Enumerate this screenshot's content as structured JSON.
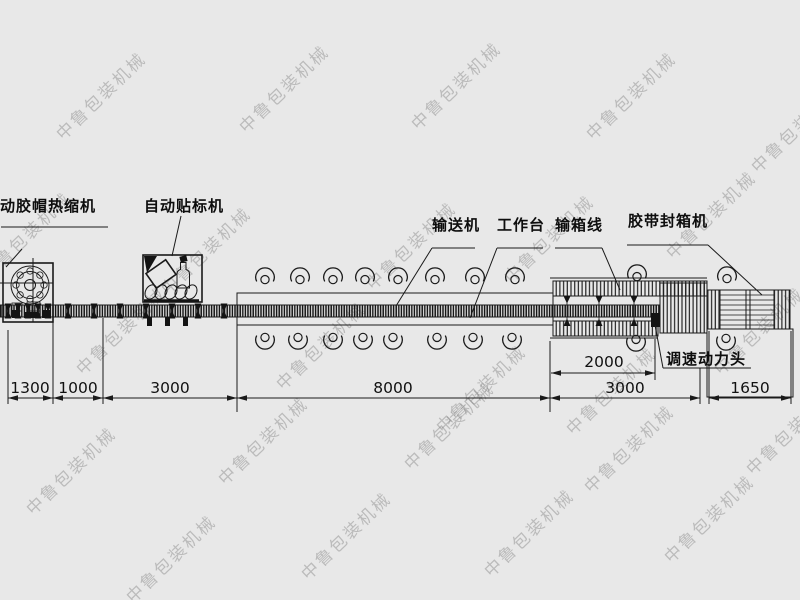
{
  "watermark": {
    "text": "中鲁包装机械"
  },
  "machine_labels": {
    "heat_shrink": "动胶帽热缩机",
    "labeler": "自动贴标机",
    "conveyor": "输送机",
    "worktable": "工作台",
    "box_line": "输箱线",
    "tape_sealer": "胶带封箱机",
    "power_head": "调速动力头"
  },
  "dimensions_mm": {
    "shrink_zone": "1300",
    "gap_zone": "1000",
    "infeed_conveyor": "3000",
    "worktable_conveyor": "8000",
    "box_line_rollers": "2000",
    "box_line_total": "3000",
    "tape_sealer": "1650"
  },
  "icons": {
    "operator_symbol": "operator-top-view-icon",
    "bottle_symbol": "bottle-top-view-icon"
  },
  "colors": {
    "background": "#e8e8e8",
    "line": "#1a1a1a",
    "watermark": "#c6c6c6"
  }
}
